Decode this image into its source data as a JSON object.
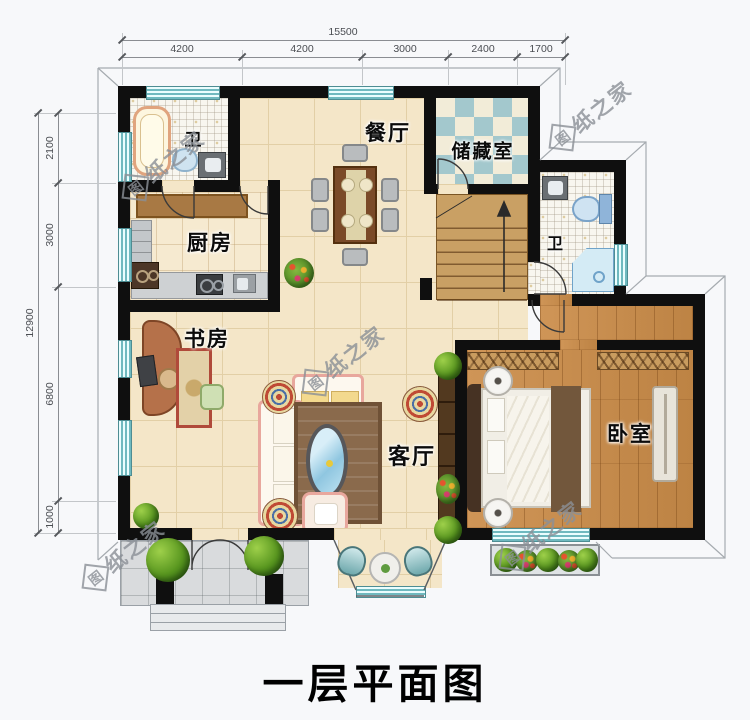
{
  "meta": {
    "title_caption": "一层平面图"
  },
  "dimensions": {
    "top": {
      "total": "15500",
      "segments": [
        "4200",
        "4200",
        "3000",
        "2400",
        "1700"
      ]
    },
    "left": {
      "total": "12900",
      "segments": [
        "2100",
        "3000",
        "6800",
        "1000"
      ]
    }
  },
  "rooms": {
    "bath1": "卫",
    "dining": "餐厅",
    "storage": "储藏室",
    "kitchen": "厨房",
    "bath2": "卫",
    "study": "书房",
    "living": "客厅",
    "bedroom": "卧室"
  },
  "watermark": {
    "badge": "图",
    "text": "纸之家"
  },
  "colors": {
    "wall": "#0f0f0f",
    "floor_cream": "#f4e6c8",
    "floor_wood": "#c68d4f",
    "storage_checker": "#a3c8cd",
    "window_glass": "#6fb9bf",
    "porch_tile": "#d9dbdd"
  }
}
